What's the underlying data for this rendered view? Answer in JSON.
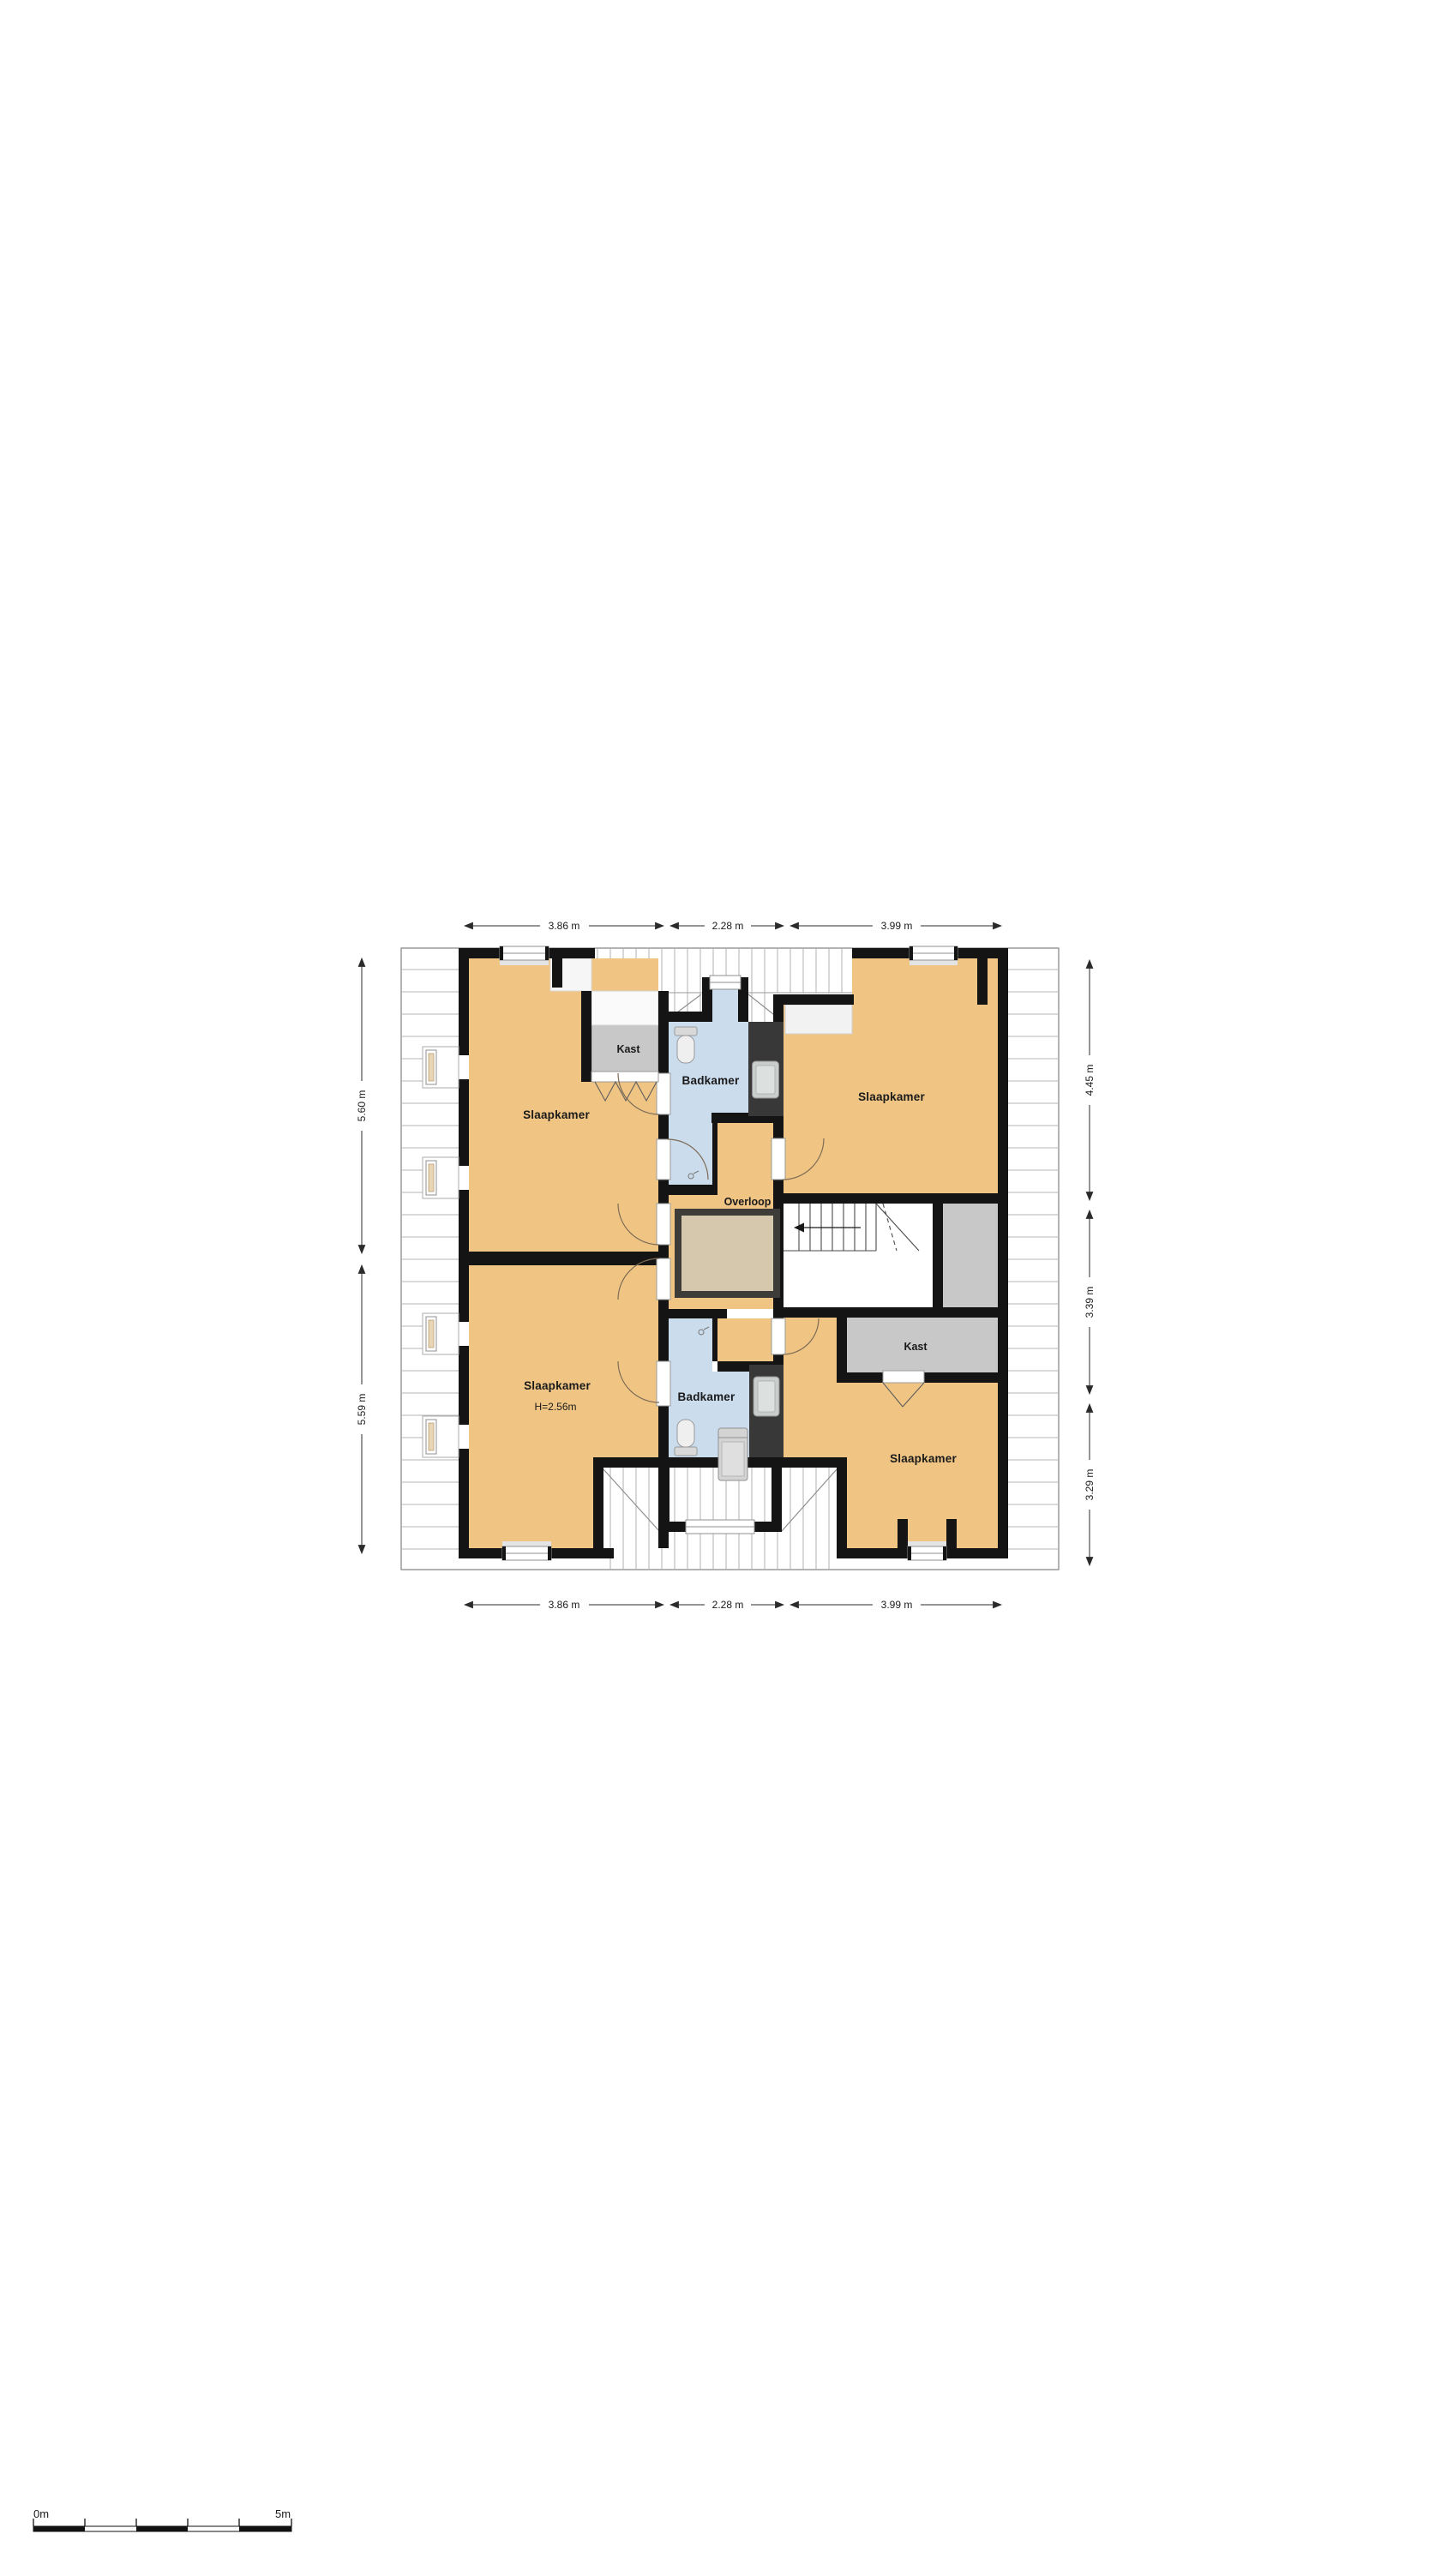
{
  "floorplan": {
    "room_labels": {
      "slaapkamer_tl": "Slaapkamer",
      "slaapkamer_tr": "Slaapkamer",
      "slaapkamer_bl": "Slaapkamer",
      "slaapkamer_bl_ceiling_height": "H=2.56m",
      "slaapkamer_br": "Slaapkamer",
      "badkamer_top": "Badkamer",
      "badkamer_bottom": "Badkamer",
      "kast_top": "Kast",
      "kast_right": "Kast",
      "overloop": "Overloop"
    },
    "dimensions": {
      "top": [
        "3.86 m",
        "2.28 m",
        "3.99 m"
      ],
      "bottom": [
        "3.86 m",
        "2.28 m",
        "3.99 m"
      ],
      "left": [
        "5.60 m",
        "5.59 m"
      ],
      "right": [
        "4.45 m",
        "3.39 m",
        "3.29 m"
      ]
    },
    "scale_bar": {
      "start": "0m",
      "end": "5m"
    },
    "colors": {
      "room": "#F0C584",
      "bathroom": "#CBDCEC",
      "closet": "#C8C8C8",
      "wall": "#141414",
      "void_fill": "#D6C8AC",
      "void_border": "#3E3C38",
      "roof_line": "#B5B5B5",
      "shower_wall": "#383838"
    }
  }
}
